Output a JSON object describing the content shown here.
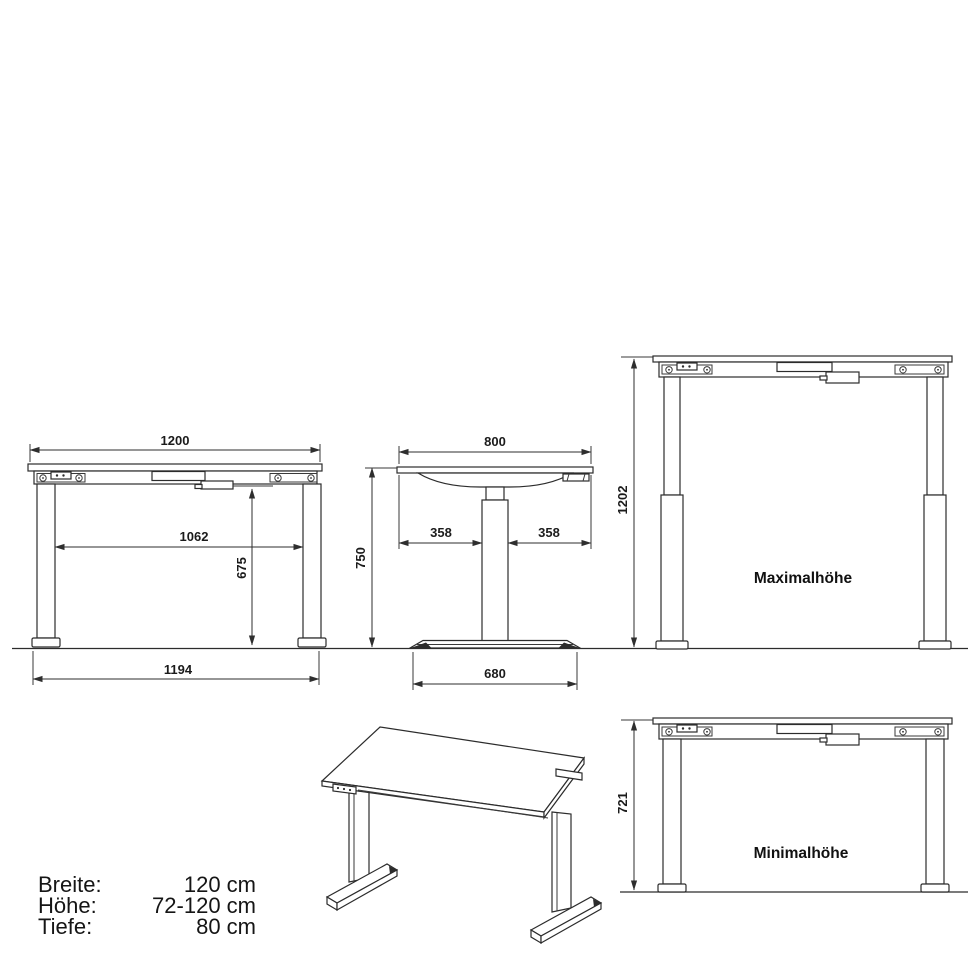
{
  "drawing": {
    "type": "furniture-dimension-diagram",
    "subject": "height-adjustable desk",
    "units": "mm"
  },
  "views": {
    "front": {
      "dims": {
        "width_top": "1200",
        "width_inner": "1062",
        "height_under_frame": "675",
        "width_feet": "1194"
      }
    },
    "side": {
      "dims": {
        "depth_top": "800",
        "offset_left": "358",
        "offset_right": "358",
        "height": "750",
        "depth_foot": "680"
      }
    },
    "max": {
      "label": "Maximalhöhe",
      "dims": {
        "height": "1202"
      }
    },
    "min": {
      "label": "Minimalhöhe",
      "dims": {
        "height": "721"
      }
    }
  },
  "specs": {
    "rows": [
      {
        "label": "Breite:",
        "value": "120 cm"
      },
      {
        "label": "Höhe:",
        "value": "72-120 cm"
      },
      {
        "label": "Tiefe:",
        "value": "80 cm"
      }
    ]
  },
  "colors": {
    "line": "#2c2c2c",
    "text": "#151515",
    "background": "#ffffff"
  }
}
